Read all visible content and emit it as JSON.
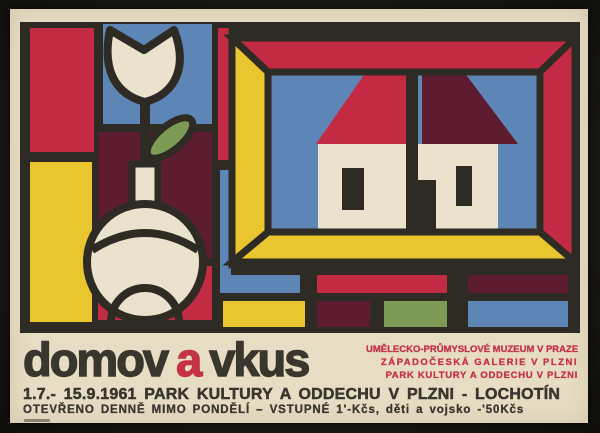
{
  "poster": {
    "title_parts": [
      "domov",
      "a",
      "vkus"
    ],
    "institutions": [
      "UMĚLECKO-PRŮMYSLOVÉ MUZEUM V PRAZE",
      "ZÁPADOČESKÁ GALERIE V PLZNI",
      "PARK KULTURY A ODDECHU V PLZNI"
    ],
    "date_venue": "1.7.- 15.9.1961  PARK KULTURY A ODDECHU V PLZNI - LOCHOTÍN",
    "hours_admission": "OTEVŘENO DENNĚ MIMO PONDĚLÍ  –  VSTUPNÉ 1'-Kčs, děti a vojsko -'50Kčs",
    "year_shown": "1961",
    "artwork": {
      "motifs": [
        "tulip-in-vase",
        "house-in-picture-frame",
        "mosaic-tiles"
      ]
    },
    "palette": {
      "backdrop": "#181714",
      "paper": "#e7ddc4",
      "ink": "#2d2b24",
      "red": "#c32b45",
      "yellow": "#e9c52f",
      "blue": "#5d85b5",
      "maroon": "#5e1c31",
      "green": "#7d9b55",
      "cream": "#eae2cc",
      "text_dark": "#39362e",
      "text_red": "#c43347"
    }
  }
}
